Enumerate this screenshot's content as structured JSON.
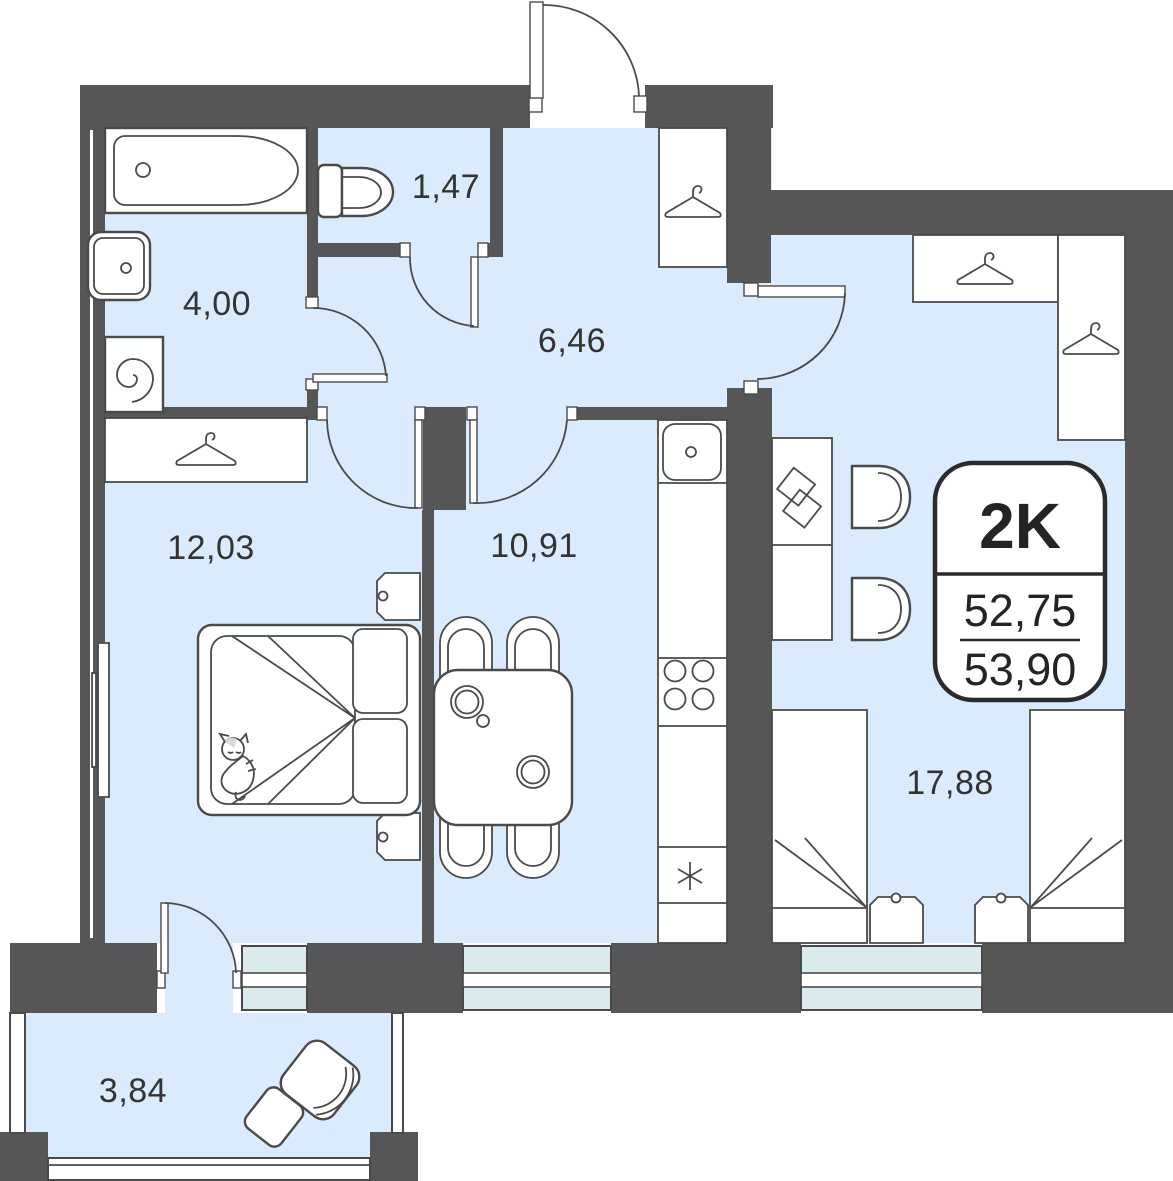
{
  "plan": {
    "badge": {
      "type_label": "2K",
      "area_living": "52,75",
      "area_total": "53,90"
    },
    "rooms": {
      "bathroom": {
        "area": "4,00"
      },
      "toilet": {
        "area": "1,47"
      },
      "hallway": {
        "area": "6,46"
      },
      "bedroom": {
        "area": "12,03"
      },
      "kitchen": {
        "area": "10,91"
      },
      "living": {
        "area": "17,88"
      },
      "balcony": {
        "area": "3,84"
      }
    },
    "colors": {
      "wall": "#565656",
      "floor": "#D9EBFC",
      "glass": "#DBEAEC",
      "outline": "#4A4A4A"
    }
  }
}
